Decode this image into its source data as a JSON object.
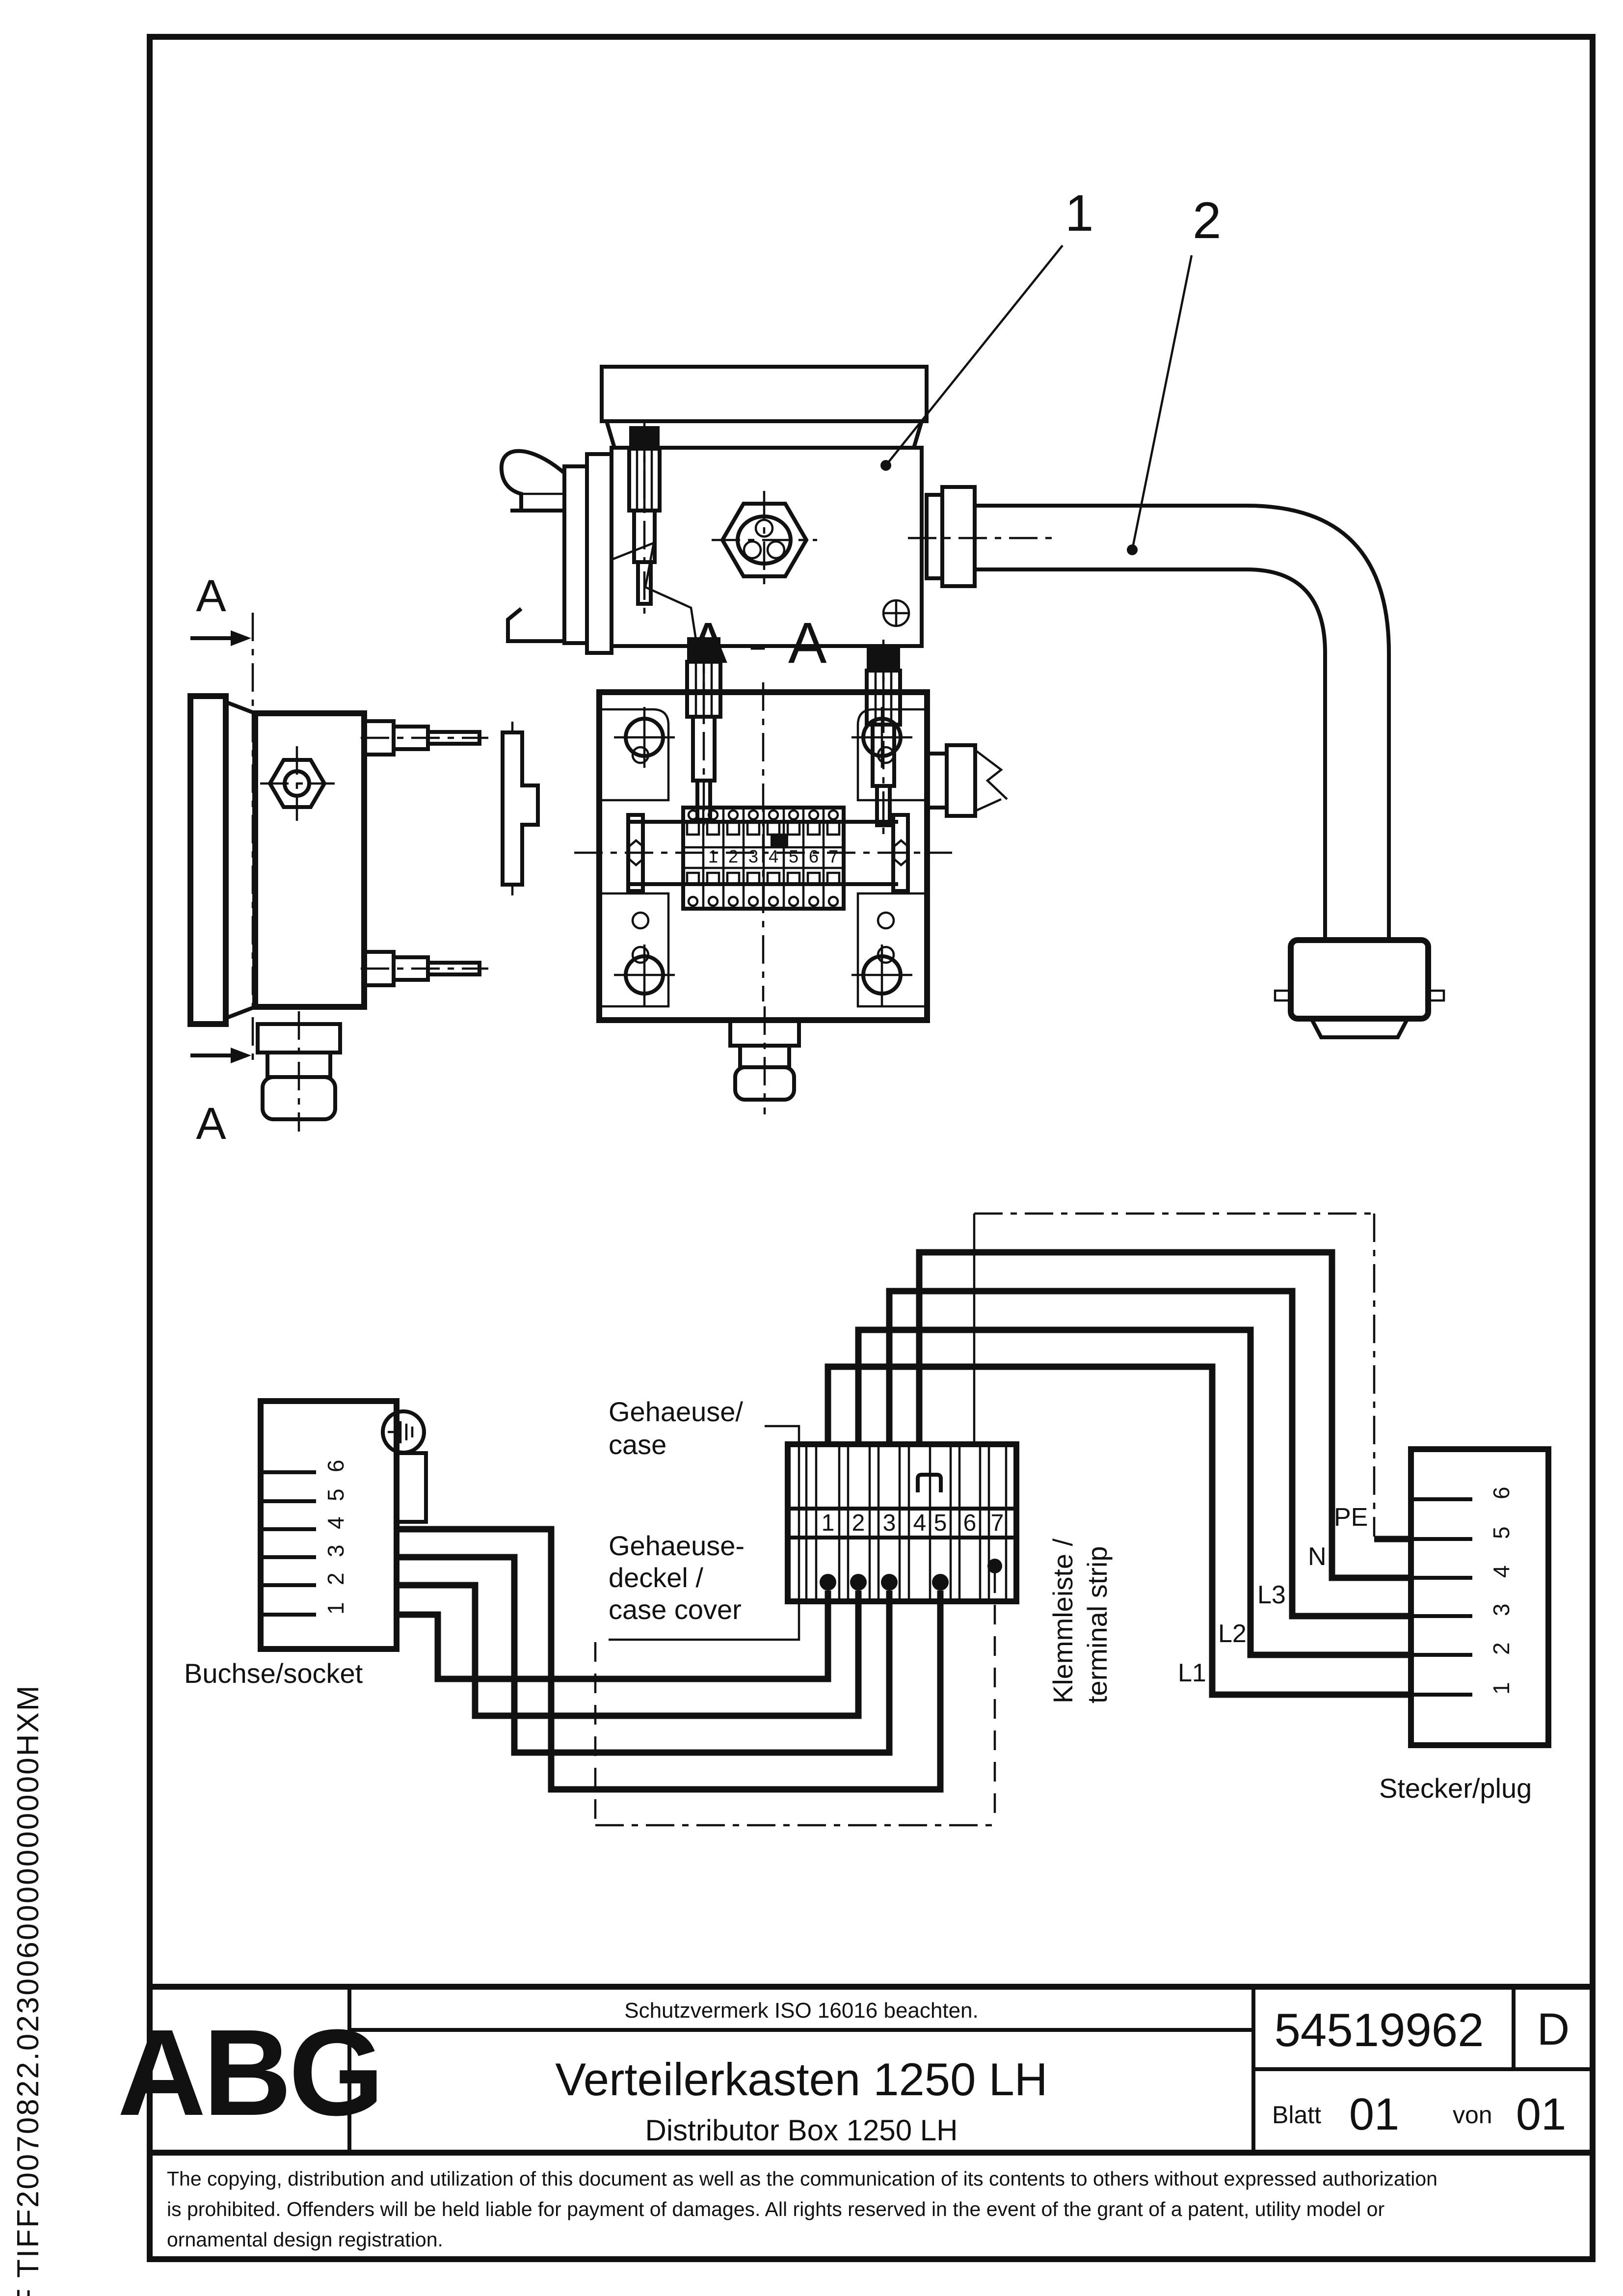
{
  "drawing": {
    "callouts": {
      "c1": "1",
      "c2": "2"
    },
    "section": {
      "marker": "A",
      "title": "A - A"
    },
    "schematic": {
      "socket_label": "Buchse/socket",
      "case_label_1": "Gehaeuse/",
      "case_label_2": "case",
      "cover_label_1": "Gehaeuse-",
      "cover_label_2": "deckel /",
      "cover_label_3": "case cover",
      "terminal_label_1": "Klemmleiste /",
      "terminal_label_2": "terminal strip",
      "plug_label": "Stecker/plug",
      "socket_pins": [
        "1",
        "2",
        "3",
        "4",
        "5",
        "6"
      ],
      "terminals": [
        "1",
        "2",
        "3",
        "4",
        "5",
        "6",
        "7"
      ],
      "plug_pins": [
        "1",
        "2",
        "3",
        "4",
        "5",
        "6"
      ],
      "wire_labels": {
        "l1": "L1",
        "l2": "L2",
        "l3": "L3",
        "n": "N",
        "pe": "PE"
      }
    }
  },
  "title_block": {
    "logo": "ABG",
    "notice": "Schutzvermerk ISO 16016 beachten.",
    "title_de": "Verteilerkasten 1250 LH",
    "title_en": "Distributor Box 1250 LH",
    "doc_number": "54519962",
    "revision": "D",
    "sheet_label": "Blatt",
    "sheet_no": "01",
    "of_label": "von",
    "of_total": "01"
  },
  "footer": {
    "line1": "The copying, distribution and utilization of this document as well as the communication of its contents to others without expressed authorization",
    "line2": "is prohibited. Offenders will be held liable for payment of damages. All rights reserved in the event of the grant of a patent, utility model or",
    "line3": "ornamental design registration."
  },
  "side_text": "F TIFF20070822.0230060000000000HXM"
}
